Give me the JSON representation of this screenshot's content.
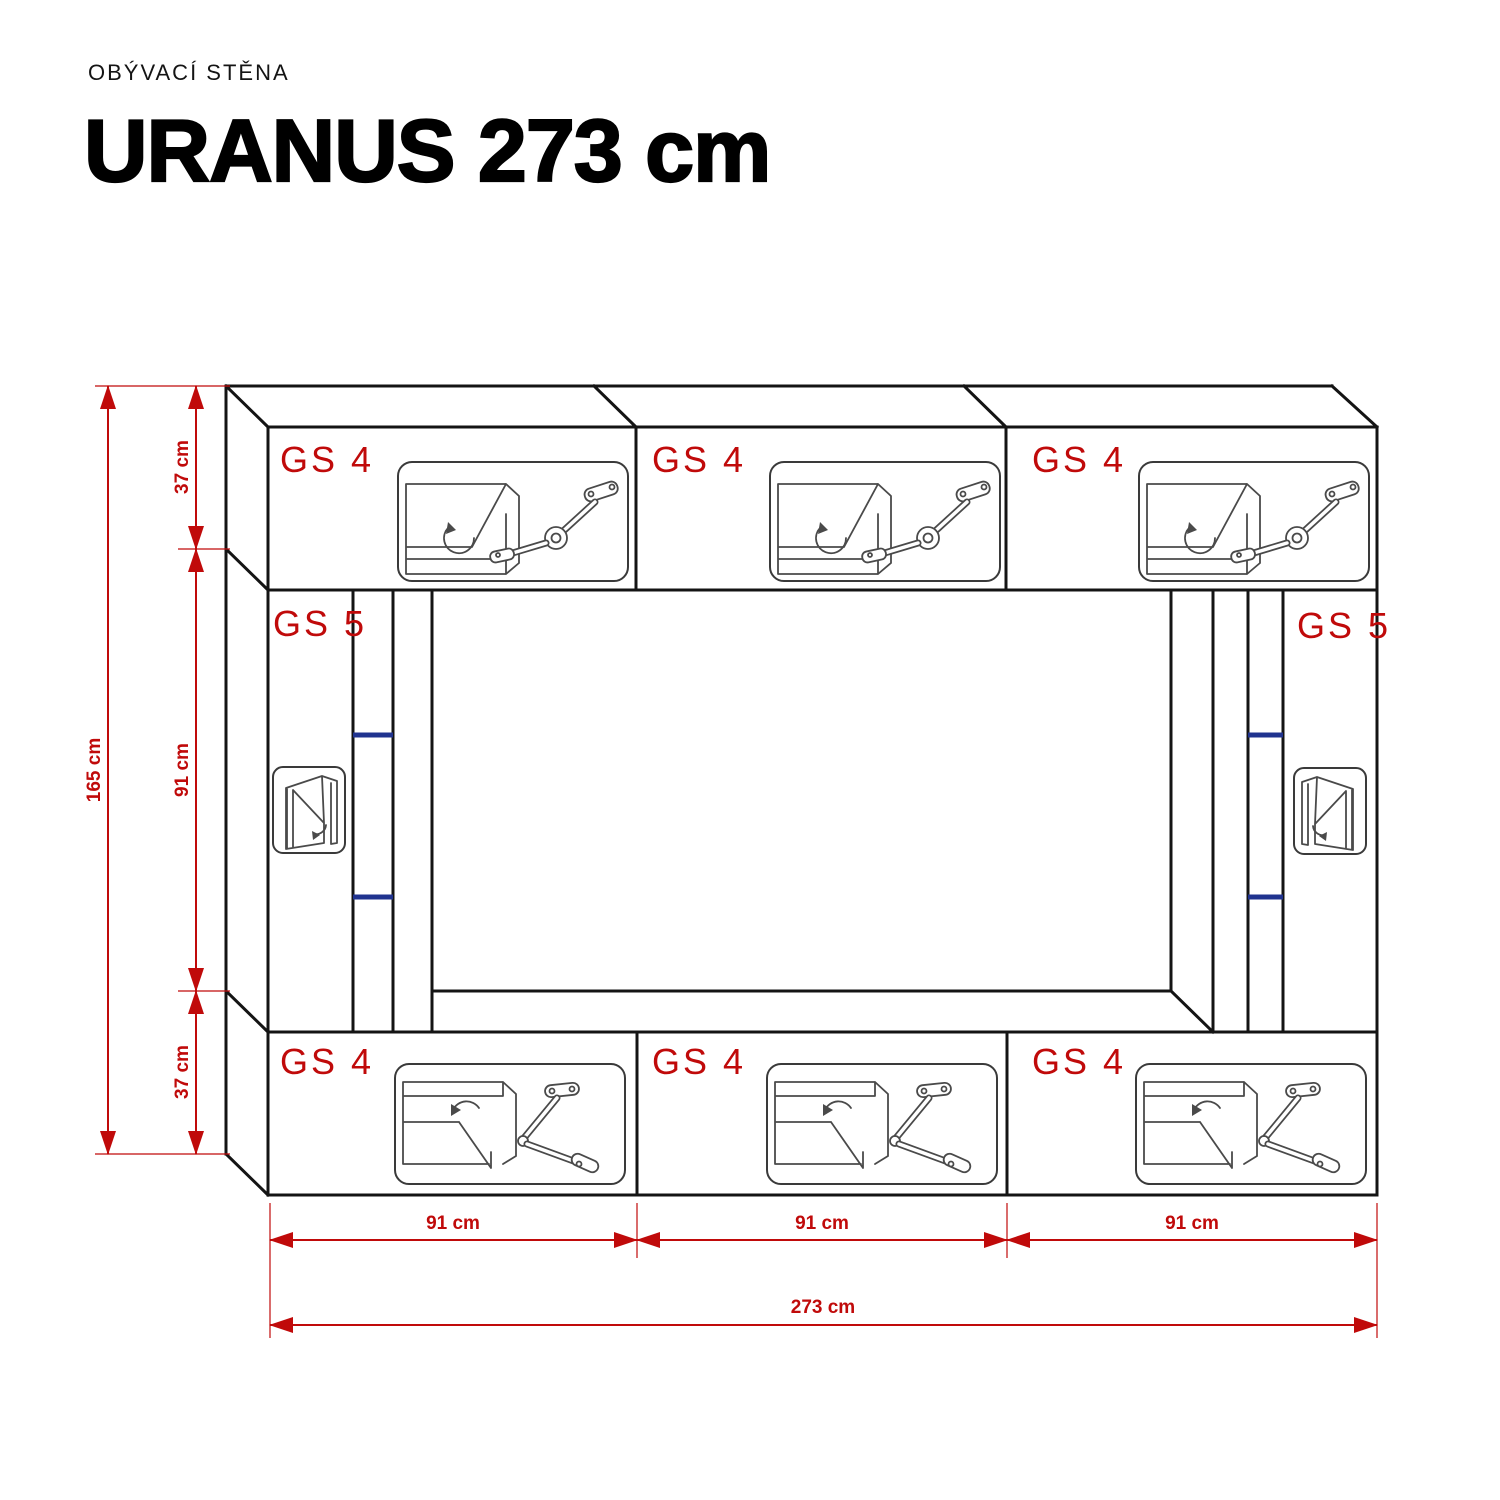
{
  "header": {
    "subtitle": "OBÝVACÍ STĚNA",
    "title": "URANUS 273 cm"
  },
  "unit": {
    "top_row": [
      {
        "label": "GS 4"
      },
      {
        "label": "GS 4"
      },
      {
        "label": "GS 4"
      }
    ],
    "middle_row": [
      {
        "label": "GS 5"
      },
      {
        "label": "GS 5"
      }
    ],
    "bottom_row": [
      {
        "label": "GS 4"
      },
      {
        "label": "GS 4"
      },
      {
        "label": "GS 4"
      }
    ]
  },
  "dimensions": {
    "total_height": "165 cm",
    "top_section_height": "37 cm",
    "middle_section_height": "91 cm",
    "bottom_section_height": "37 cm",
    "section_widths": [
      "91 cm",
      "91 cm",
      "91 cm"
    ],
    "total_width": "273 cm"
  },
  "icons": {
    "top_cabinet": "flap-up-door-mechanism-icon",
    "bottom_cabinet": "flap-down-door-mechanism-icon",
    "side_cabinet": "hinged-door-icon"
  },
  "colors": {
    "dimension_red": "#C00A0A",
    "label_red": "#C00A0A",
    "shelf_blue": "#20338F",
    "outline_black": "#141414"
  }
}
